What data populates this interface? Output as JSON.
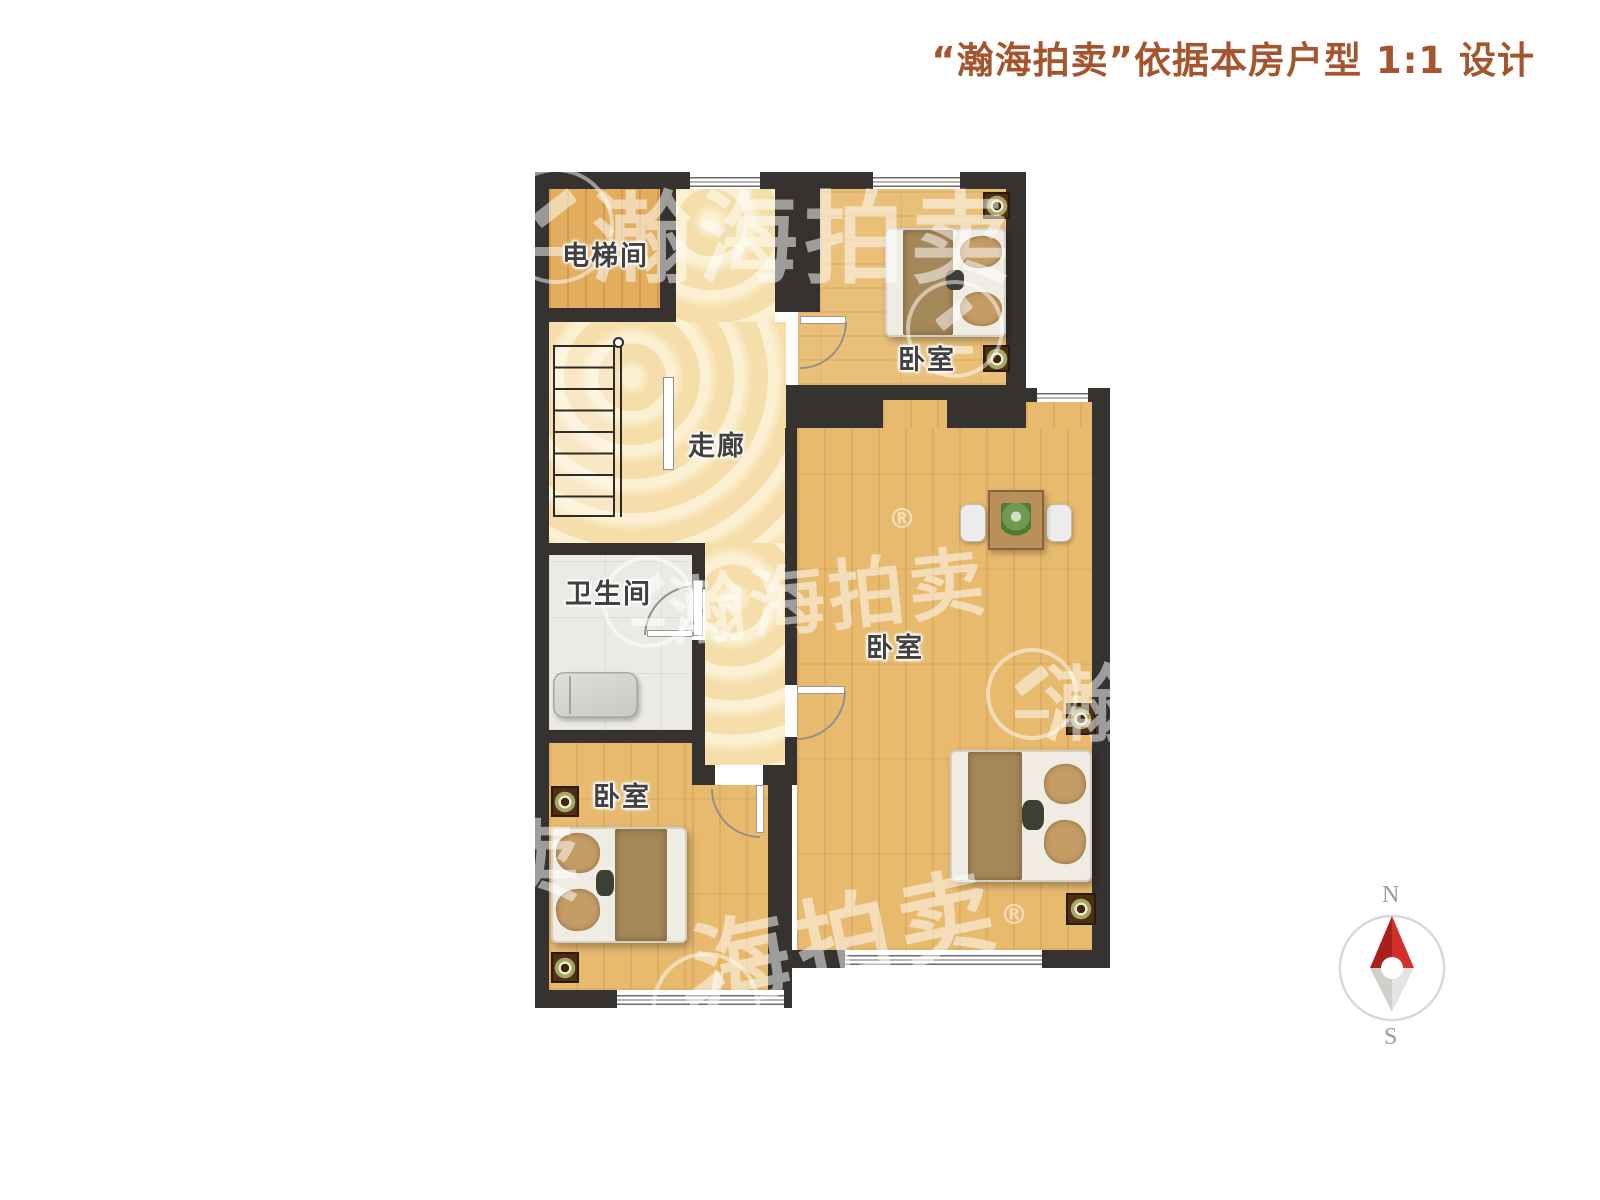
{
  "header": {
    "title": "“瀚海拍卖”依据本房户型 1:1 设计"
  },
  "rooms": {
    "elevator": {
      "label": "电梯间"
    },
    "corridor": {
      "label": "走廊"
    },
    "bathroom": {
      "label": "卫生间"
    },
    "bedroom_top": {
      "label": "卧室"
    },
    "bedroom_main": {
      "label": "卧室"
    },
    "bedroom_bottom": {
      "label": "卧室"
    }
  },
  "compass": {
    "north": "N",
    "south": "S"
  },
  "watermark": {
    "brand": "瀚海拍卖",
    "registered": "®",
    "fragment_right": "瀚",
    "fragment_bottom": "海拍卖",
    "fragment_left": "卖"
  },
  "colors": {
    "title_text": "#A5552D",
    "wall": "#35322F",
    "wood_floor": "#E7BA6E",
    "corridor_floor": "#F7E3B2",
    "bathroom_floor": "#EBEAE5",
    "compass_north_arrow": "#C3281F",
    "compass_south_arrow": "#DCDCDA"
  }
}
